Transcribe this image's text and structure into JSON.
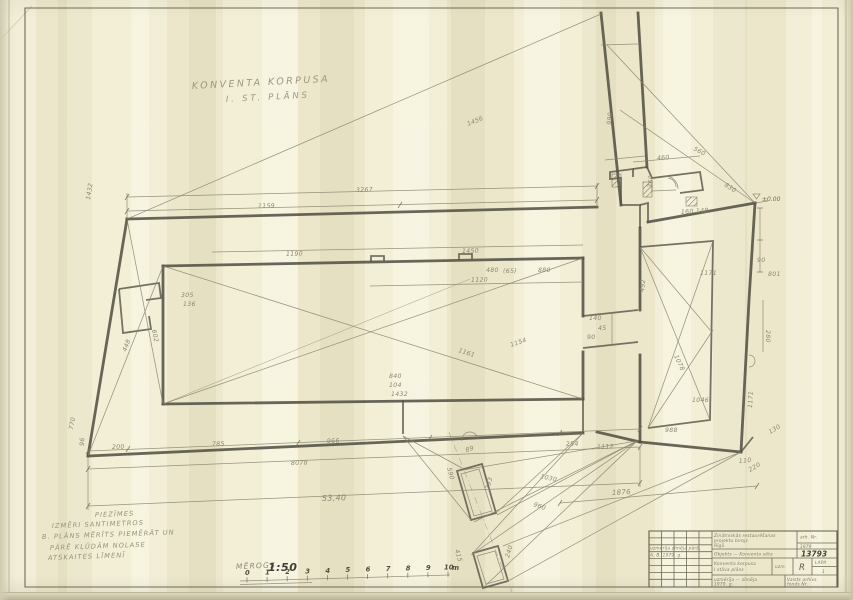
{
  "sheet": {
    "title_lines": [
      "KONVENTA KORPUSA",
      "I. ST. PLĀNS"
    ],
    "notes": [
      "PIEZĪMES",
      "IZMĒRI SANTIMETROS",
      "B. PLĀNS MĒRĪTS PIEMĒRĀT UN",
      "PĀRĒ KĻŪDĀM NOLASE",
      "ATSKAITES LĪMENĪ"
    ],
    "colors": {
      "paper": "#f1ecd1",
      "pencil": "#86836d",
      "wall": "#4e4c3f",
      "handwriting": "#8b8871"
    }
  },
  "scale_bar": {
    "label": "MĒROGS",
    "ratio": "1:50",
    "unit": "m",
    "ticks": [
      "0",
      "1",
      "2",
      "3",
      "4",
      "5",
      "6",
      "7",
      "8",
      "9",
      "10"
    ]
  },
  "title_block": {
    "org_lines": [
      "Zinātniskās restaurēšanas",
      "projektu birojs",
      "Rīgā"
    ],
    "archive_lines": [
      "arh. Nr.",
      "1979"
    ],
    "object_line": "Objekts — Konventa sēta",
    "project_number": "13793",
    "drawing_lines": [
      "Konventa korpusa",
      "I stāva plāns"
    ],
    "checked_label": "uzm.",
    "series_letter": "R",
    "sheet_label": "LAPA",
    "sheet_number": "1",
    "footer_left_lines": [
      "uzmērīja — zīmēja",
      "1979. g."
    ],
    "footer_right_lines": [
      "Valsts arhīvs",
      "fonds Nr."
    ],
    "sig_rows": [
      "uzmērīja  zīmēja  pārb.",
      "A. B.  1979. g."
    ]
  },
  "plan": {
    "level_mark": "±0.00",
    "dimensions": [
      {
        "t": "1159",
        "x": 258,
        "y": 208,
        "r": -1
      },
      {
        "t": "3267",
        "x": 356,
        "y": 192,
        "r": -2
      },
      {
        "t": "1432",
        "x": 90,
        "y": 200,
        "r": -81
      },
      {
        "t": "1190",
        "x": 286,
        "y": 256,
        "r": -1
      },
      {
        "t": "1450",
        "x": 462,
        "y": 253,
        "r": -1
      },
      {
        "t": "880",
        "x": 538,
        "y": 272,
        "r": 0
      },
      {
        "t": "(65)",
        "x": 503,
        "y": 273,
        "r": 0
      },
      {
        "t": "480",
        "x": 486,
        "y": 272,
        "r": 0
      },
      {
        "t": "305",
        "x": 181,
        "y": 297,
        "r": 0
      },
      {
        "t": "136",
        "x": 183,
        "y": 306,
        "r": 0
      },
      {
        "t": "990",
        "x": 611,
        "y": 125,
        "r": -84
      },
      {
        "t": "1456",
        "x": 468,
        "y": 126,
        "r": -22
      },
      {
        "t": "460",
        "x": 657,
        "y": 160,
        "r": -3
      },
      {
        "t": "560",
        "x": 693,
        "y": 150,
        "r": 28
      },
      {
        "t": "830",
        "x": 724,
        "y": 186,
        "r": 33
      },
      {
        "t": "360",
        "x": 652,
        "y": 188,
        "r": -85
      },
      {
        "t": "160",
        "x": 681,
        "y": 214,
        "r": -3
      },
      {
        "t": "148",
        "x": 696,
        "y": 213,
        "r": -3
      },
      {
        "t": "1120",
        "x": 471,
        "y": 282,
        "r": -1
      },
      {
        "t": "1161",
        "x": 458,
        "y": 352,
        "r": 18
      },
      {
        "t": "1154",
        "x": 511,
        "y": 347,
        "r": -19
      },
      {
        "t": "602",
        "x": 152,
        "y": 330,
        "r": 79
      },
      {
        "t": "448",
        "x": 126,
        "y": 352,
        "r": -68
      },
      {
        "t": "840",
        "x": 389,
        "y": 378,
        "r": 0
      },
      {
        "t": "104",
        "x": 389,
        "y": 387,
        "r": 0
      },
      {
        "t": "1432",
        "x": 391,
        "y": 396,
        "r": 0
      },
      {
        "t": "140",
        "x": 589,
        "y": 320,
        "r": 0
      },
      {
        "t": "45",
        "x": 598,
        "y": 330,
        "r": 0
      },
      {
        "t": "90",
        "x": 587,
        "y": 339,
        "r": 0
      },
      {
        "t": "1171",
        "x": 700,
        "y": 275,
        "r": 0
      },
      {
        "t": "801",
        "x": 768,
        "y": 276,
        "r": 0
      },
      {
        "t": "90",
        "x": 757,
        "y": 262,
        "r": 0
      },
      {
        "t": "280",
        "x": 766,
        "y": 330,
        "r": 90
      },
      {
        "t": "1171",
        "x": 752,
        "y": 408,
        "r": -87
      },
      {
        "t": "492",
        "x": 644,
        "y": 292,
        "r": -84
      },
      {
        "t": "1078",
        "x": 674,
        "y": 356,
        "r": 65
      },
      {
        "t": "1046",
        "x": 692,
        "y": 402,
        "r": 0
      },
      {
        "t": "988",
        "x": 665,
        "y": 432,
        "r": 0
      },
      {
        "t": "130",
        "x": 770,
        "y": 434,
        "r": -30
      },
      {
        "t": "110",
        "x": 739,
        "y": 463,
        "r": -5
      },
      {
        "t": "220",
        "x": 750,
        "y": 472,
        "r": -30
      },
      {
        "t": "200",
        "x": 112,
        "y": 449,
        "r": -2
      },
      {
        "t": "785",
        "x": 212,
        "y": 446,
        "r": -2
      },
      {
        "t": "966",
        "x": 327,
        "y": 443,
        "r": -2
      },
      {
        "t": "8078",
        "x": 291,
        "y": 465,
        "r": -2
      },
      {
        "t": "53,40",
        "x": 322,
        "y": 501,
        "r": -2,
        "s": 8
      },
      {
        "t": "1876",
        "x": 612,
        "y": 495,
        "r": -3,
        "s": 7
      },
      {
        "t": "254",
        "x": 566,
        "y": 446,
        "r": -2
      },
      {
        "t": "1112",
        "x": 597,
        "y": 449,
        "r": -2
      },
      {
        "t": "590",
        "x": 447,
        "y": 468,
        "r": 75
      },
      {
        "t": "1030",
        "x": 540,
        "y": 478,
        "r": 13
      },
      {
        "t": "960",
        "x": 533,
        "y": 506,
        "r": 20
      },
      {
        "t": "293",
        "x": 489,
        "y": 490,
        "r": -73
      },
      {
        "t": "240",
        "x": 509,
        "y": 558,
        "r": -73
      },
      {
        "t": "415",
        "x": 455,
        "y": 550,
        "r": 75
      },
      {
        "t": "89",
        "x": 466,
        "y": 452,
        "r": -15
      },
      {
        "t": "770",
        "x": 73,
        "y": 430,
        "r": -80
      },
      {
        "t": "96",
        "x": 84,
        "y": 446,
        "r": -88
      }
    ]
  }
}
